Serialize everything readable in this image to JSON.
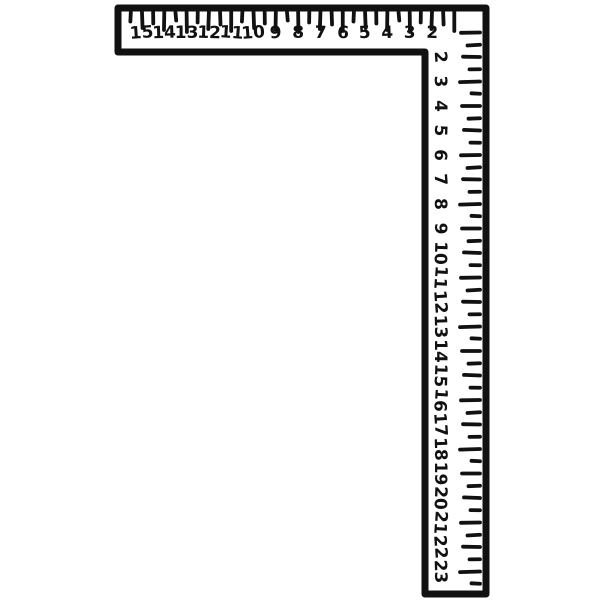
{
  "figure": {
    "name": "framing-square-illustration",
    "background_color": "#ffffff",
    "ink_color": "#111111",
    "horizontal_scale": {
      "numbers": [
        15,
        14,
        13,
        12,
        11,
        10,
        9,
        8,
        7,
        6,
        5,
        4,
        3,
        2
      ],
      "direction": "right-to-left-increasing",
      "tick_step": 0.5,
      "long_tick_on": "integer",
      "short_tick_on": "half"
    },
    "vertical_scale": {
      "numbers": [
        2,
        3,
        4,
        5,
        6,
        7,
        8,
        9,
        10,
        11,
        12,
        13,
        14,
        15,
        16,
        17,
        18,
        19,
        20,
        21,
        22,
        23
      ],
      "direction": "top-to-bottom-increasing",
      "digit_rotation_deg": 90,
      "tick_step": 0.5,
      "long_tick_on": "integer",
      "short_tick_on": "half"
    }
  }
}
